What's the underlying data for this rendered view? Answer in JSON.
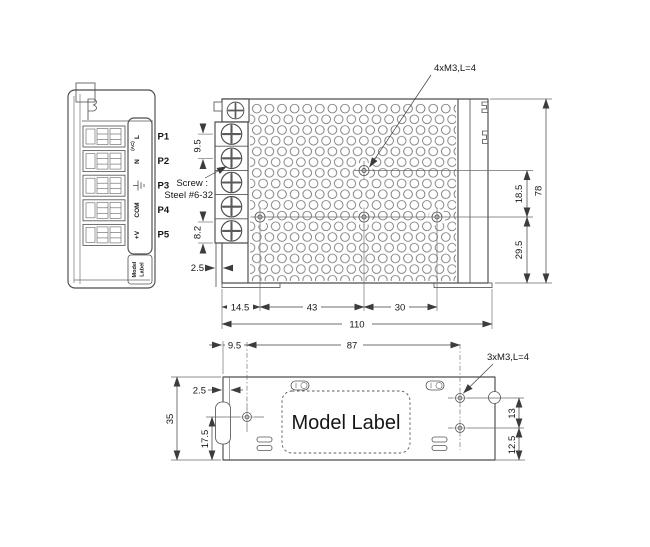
{
  "drawing": {
    "background": "#ffffff",
    "line_color": "#4d4d4d",
    "text_color": "#161616"
  },
  "end_view": {
    "pin_labels": [
      "P1",
      "P2",
      "P3",
      "P4",
      "P5"
    ],
    "terminal_live": "L",
    "terminal_live_sub": "(AC)",
    "terminal_neutral": "N",
    "terminal_ground_icon": "earth-ground",
    "terminal_com": "COM",
    "terminal_vpos": "+V",
    "model_label_line1": "Model",
    "model_label_line2": "Label"
  },
  "front_view": {
    "mounting_callout": "4xM3,L=4",
    "screw_note_line1": "Screw :",
    "screw_note_line2": "Steel #6-32",
    "dim_terminal_pitch": "9.5",
    "dim_terminal_bottom": "8.2",
    "dim_block_offset": "2.5",
    "dim_hole_offset_left": "14.5",
    "dim_hole_spacing_1": "43",
    "dim_hole_spacing_2": "30",
    "dim_overall_width": "110",
    "dim_hole_row_gap": "18.5",
    "dim_hole_row_bottom": "29.5",
    "dim_overall_height": "78"
  },
  "bottom_view": {
    "mounting_callout": "3xM3,L=4",
    "model_label": "Model Label",
    "dim_hole_offset_left": "9.5",
    "dim_hole_spacing": "87",
    "dim_edge_offset": "2.5",
    "dim_overall_depth": "35",
    "dim_hole_offset_bottom": "17.5",
    "dim_hole_gap": "13",
    "dim_hole_edge_bottom": "12.5"
  }
}
